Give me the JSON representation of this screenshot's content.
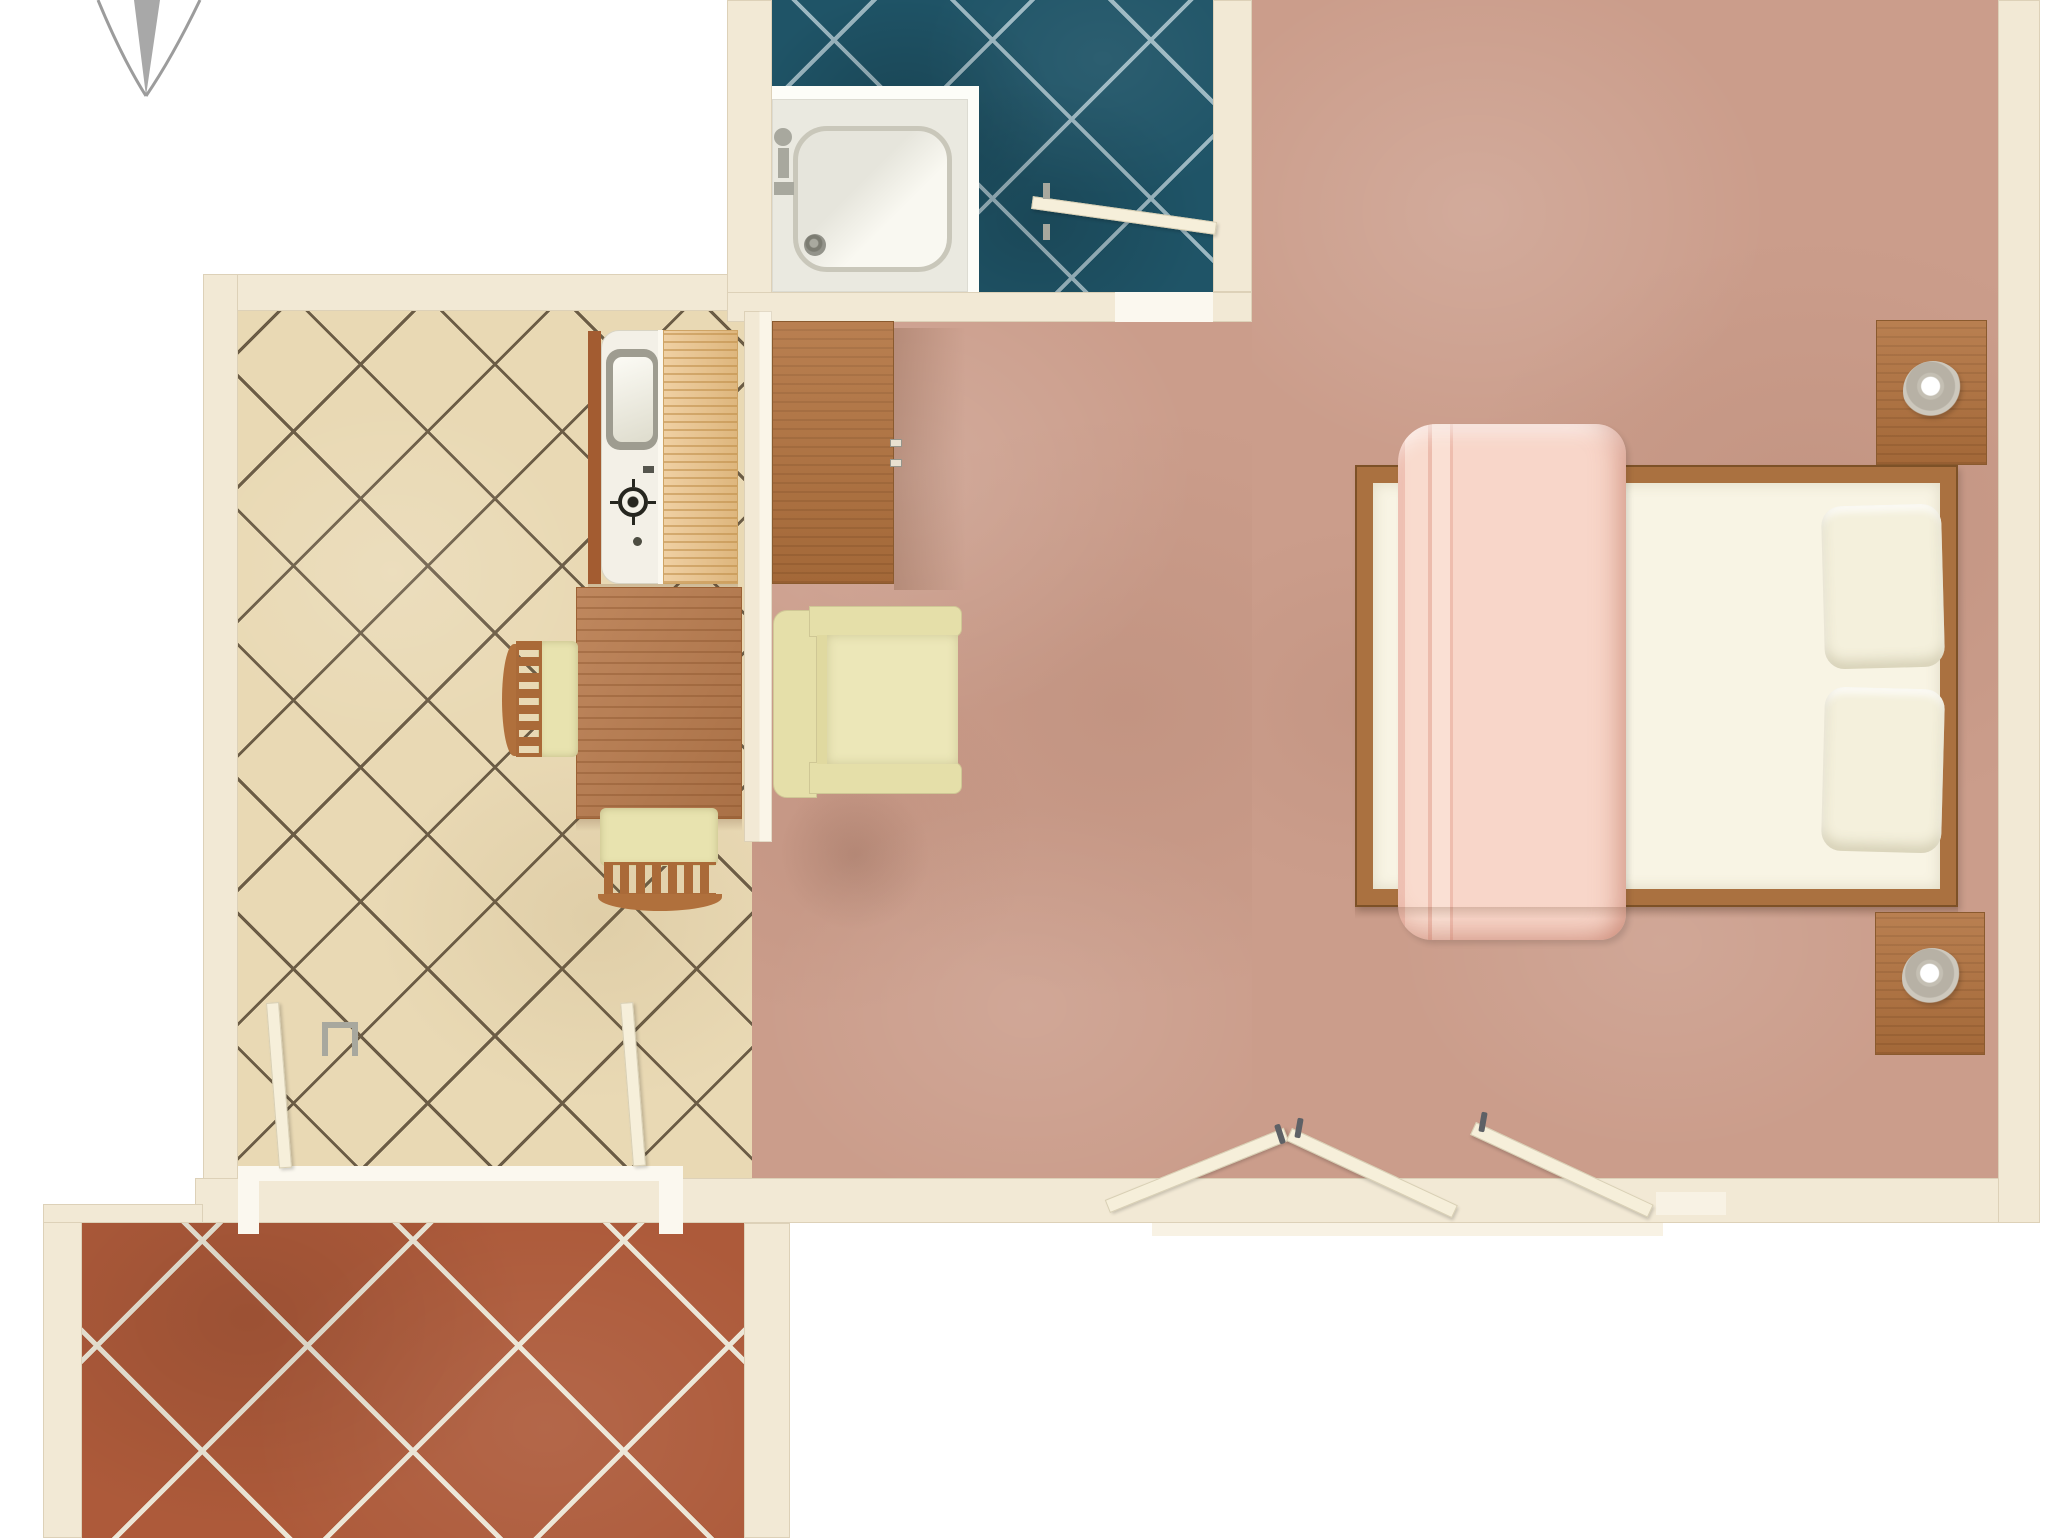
{
  "meta": {
    "kind": "apartment-floor-plan",
    "view": "top-down-3d-render",
    "visible_text": "none"
  },
  "palette": {
    "outside": "#ffffff",
    "wall": "#f2e9d5",
    "wall-light": "#f8f2e4",
    "threshold": "#fbf8ef",
    "carpet": "#cb9d8b",
    "tile-kitchen": "#e9d9b4",
    "grout-kitchen": "#6b5c45",
    "tile-bath": "#1f5467",
    "grout-bath": "#9cb8c2",
    "tile-terrace": "#ad5a3a",
    "grout-terrace": "#ece6d6",
    "wood": "#b1713d",
    "wood-dark": "#8a5a2e",
    "wood-bed": "#aa7140",
    "maple": "#eac084",
    "table": "#b87a4c",
    "wood-chair": "#aa6a38",
    "wood-chair-bar": "#b0703c",
    "seat": "#e8e3af",
    "armchair": "#e5dfa9",
    "armchair-seat": "#ece7b8",
    "mattress": "#f8f4e4",
    "pillow": "#f4f0dc",
    "blanket": "#f8d6c9",
    "shower": "#eae9e0",
    "counter-white": "#f3f0e7",
    "counter-edge": "#a35c31",
    "metal": "#a8a89e",
    "metal-rim": "#9e9c90",
    "metal-dark": "#5e6166",
    "door-leaf": "#f6efda",
    "door-edge": "#d8cfb4",
    "compass": "#a8a8a8"
  },
  "rooms": {
    "bathroom": {
      "floor": "teal-diagonal-tiles",
      "items": [
        "shower-tray",
        "shower-faucet",
        "drain",
        "door-leaf"
      ]
    },
    "kitchen": {
      "floor": "beige-diagonal-tiles",
      "items": [
        "sink-counter",
        "gas-burner",
        "maple-counter",
        "dining-table",
        "chair",
        "chair",
        "french-door-leaf",
        "french-door-leaf",
        "door-handle"
      ]
    },
    "bedroom_living": {
      "floor": "salmon-carpet",
      "items": [
        "wardrobe-cabinet",
        "armchair",
        "double-bed",
        "pink-blanket",
        "pillow",
        "pillow",
        "nightstand",
        "bedside-lamp",
        "nightstand",
        "bedside-lamp",
        "double-door-leaves"
      ]
    },
    "terrace": {
      "floor": "terracotta-diagonal-tiles",
      "items": []
    }
  },
  "compass": {
    "symbol": "north-needle",
    "position": "top-left"
  }
}
